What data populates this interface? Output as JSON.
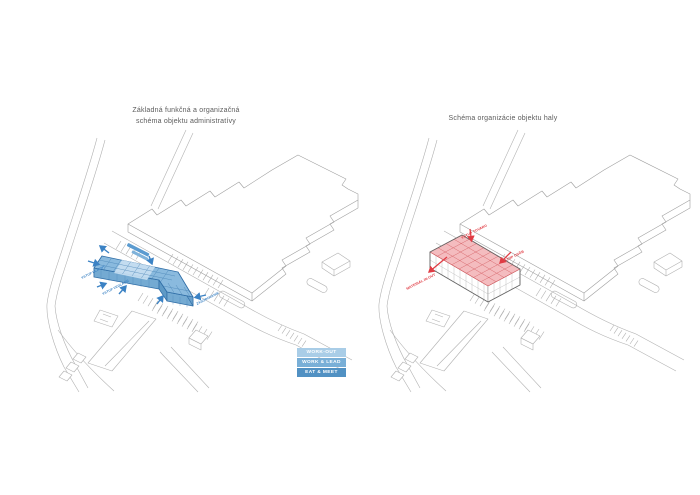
{
  "sheet": {
    "background": "#ffffff"
  },
  "left_diagram": {
    "title_line1": "Základná funkčná a organizačná",
    "title_line2": "schéma objektu administratívy",
    "accent_color": "#4a89c0",
    "arrow_labels": {
      "entry_main": "VSTUP HLAVNÝ",
      "entry_side": "VSTUP VEDĽAJŠÍ",
      "supply": "ZÁSOBOVANIE"
    },
    "legend": {
      "rows": [
        {
          "label": "WORK-OUT",
          "color": "#a9cde7"
        },
        {
          "label": "WORK & LEAD",
          "color": "#79afd7"
        },
        {
          "label": "EAT & MEET",
          "color": "#5191c3"
        }
      ]
    }
  },
  "right_diagram": {
    "title": "Schéma organizácie objektu haly",
    "accent_color": "#e04348",
    "arrow_labels": {
      "goods_entry": "VSTUP TOVARU",
      "staff_entry": "VSTUP OSÔB",
      "material_flow": "MATERIÁL IN-OUT"
    }
  }
}
